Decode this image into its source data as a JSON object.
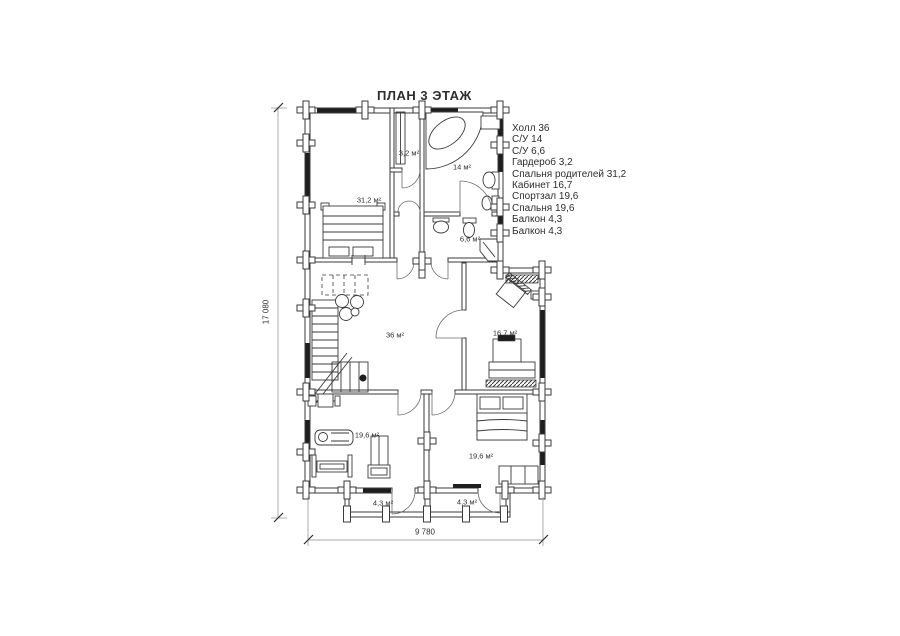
{
  "title": "ПЛАН 3 ЭТАЖ",
  "legend": {
    "items": [
      "Холл 36",
      "С/У 14",
      "С/У 6,6",
      "Гардероб 3,2",
      "Спальня родителей 31,2",
      "Кабинет 16,7",
      "Спортзал 19,6",
      "Спальня 19,6",
      "Балкон 4,3",
      "Балкон 4,3"
    ]
  },
  "room_area_labels": [
    "3,2 м²",
    "14 м²",
    "31,2 м²",
    "6,6 м²",
    "36 м²",
    "16,7 м²",
    "19,6 м²",
    "19,6 м²",
    "4,3 м²",
    "4,3 м²"
  ],
  "dimensions": {
    "total_height": "17 080",
    "total_width": "9 780"
  },
  "colors": {
    "line": "#3a3a3a",
    "text": "#2e2e2e",
    "background": "#ffffff"
  }
}
